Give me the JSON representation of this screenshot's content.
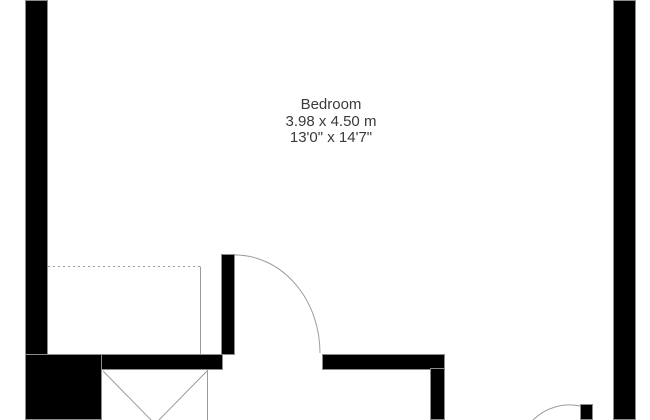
{
  "room": {
    "name": "Bedroom",
    "dimensions_metric": "3.98 x 4.50 m",
    "dimensions_imperial": "13'0\" x 14'7\""
  },
  "colors": {
    "bg": "#ffffff",
    "wall": "#000000",
    "wall_edge": "#8c8c8c",
    "line": "#9c9c9c",
    "text": "#3a3a3a"
  }
}
